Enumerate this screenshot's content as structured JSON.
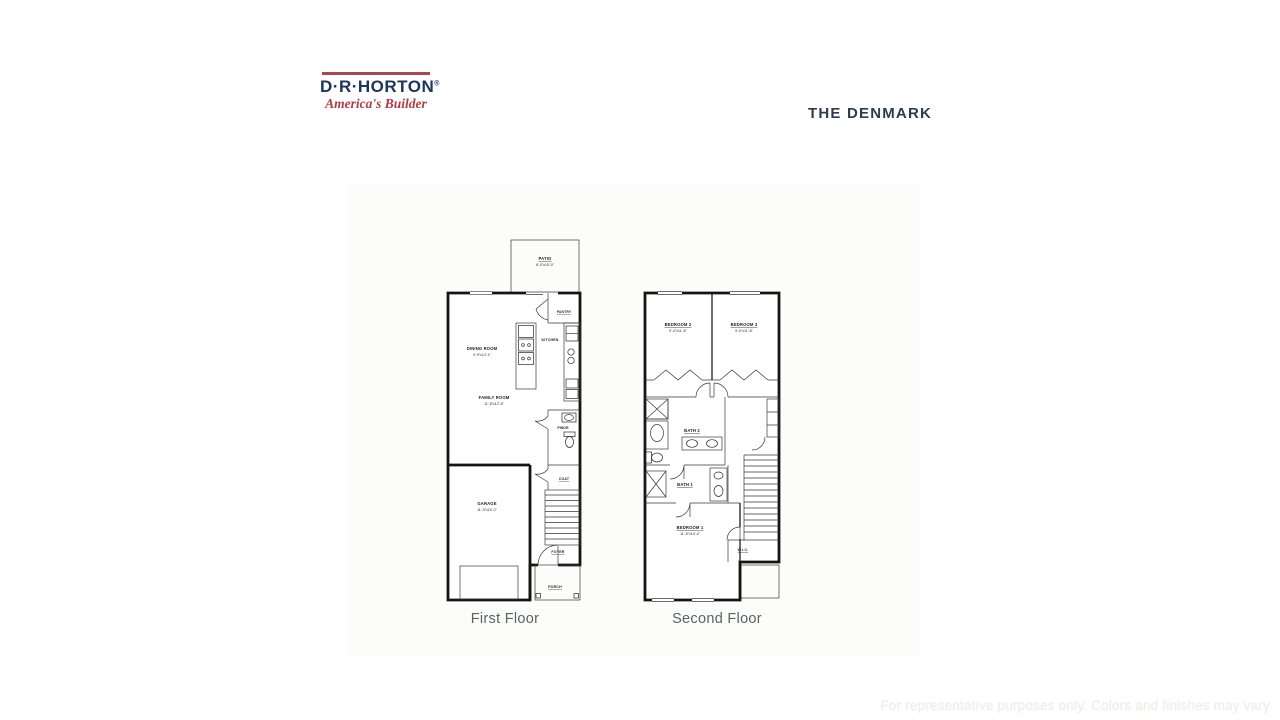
{
  "logo": {
    "wordmark": "D·R·HORTON",
    "registered_mark": "®",
    "tagline": "America's Builder"
  },
  "header": {
    "plan_title": "THE DENMARK"
  },
  "floors": {
    "first": {
      "caption": "First Floor",
      "rooms": {
        "patio": {
          "name": "PATIO",
          "dims": "8'-0\"x10'-0\""
        },
        "pantry": {
          "name": "PANTRY"
        },
        "kitchen": {
          "name": "KITCHEN"
        },
        "dining": {
          "name": "DINING ROOM",
          "dims": "9'-9\"x13'-1\""
        },
        "family": {
          "name": "FAMILY ROOM",
          "dims": "11'-8\"x12'-8\""
        },
        "pwdr": {
          "name": "PWDR"
        },
        "coat": {
          "name": "COAT"
        },
        "garage": {
          "name": "GARAGE",
          "dims": "11'-5\"x19'-2\""
        },
        "foyer": {
          "name": "FOYER"
        },
        "porch": {
          "name": "PORCH"
        }
      }
    },
    "second": {
      "caption": "Second Floor",
      "rooms": {
        "bedroom2": {
          "name": "BEDROOM 2",
          "dims": "9'-4\"x11'-8\""
        },
        "bedroom3": {
          "name": "BEDROOM 3",
          "dims": "9'-0\"x11'-8\""
        },
        "bath2": {
          "name": "BATH 2"
        },
        "bath1": {
          "name": "BATH 1"
        },
        "bedroom1": {
          "name": "BEDROOM 1",
          "dims": "11'-5\"x14'-4\""
        },
        "wic": {
          "name": "W.I.C."
        }
      }
    }
  },
  "footer": {
    "disclaimer": "For representative purposes only. Colors and finishes may vary"
  }
}
